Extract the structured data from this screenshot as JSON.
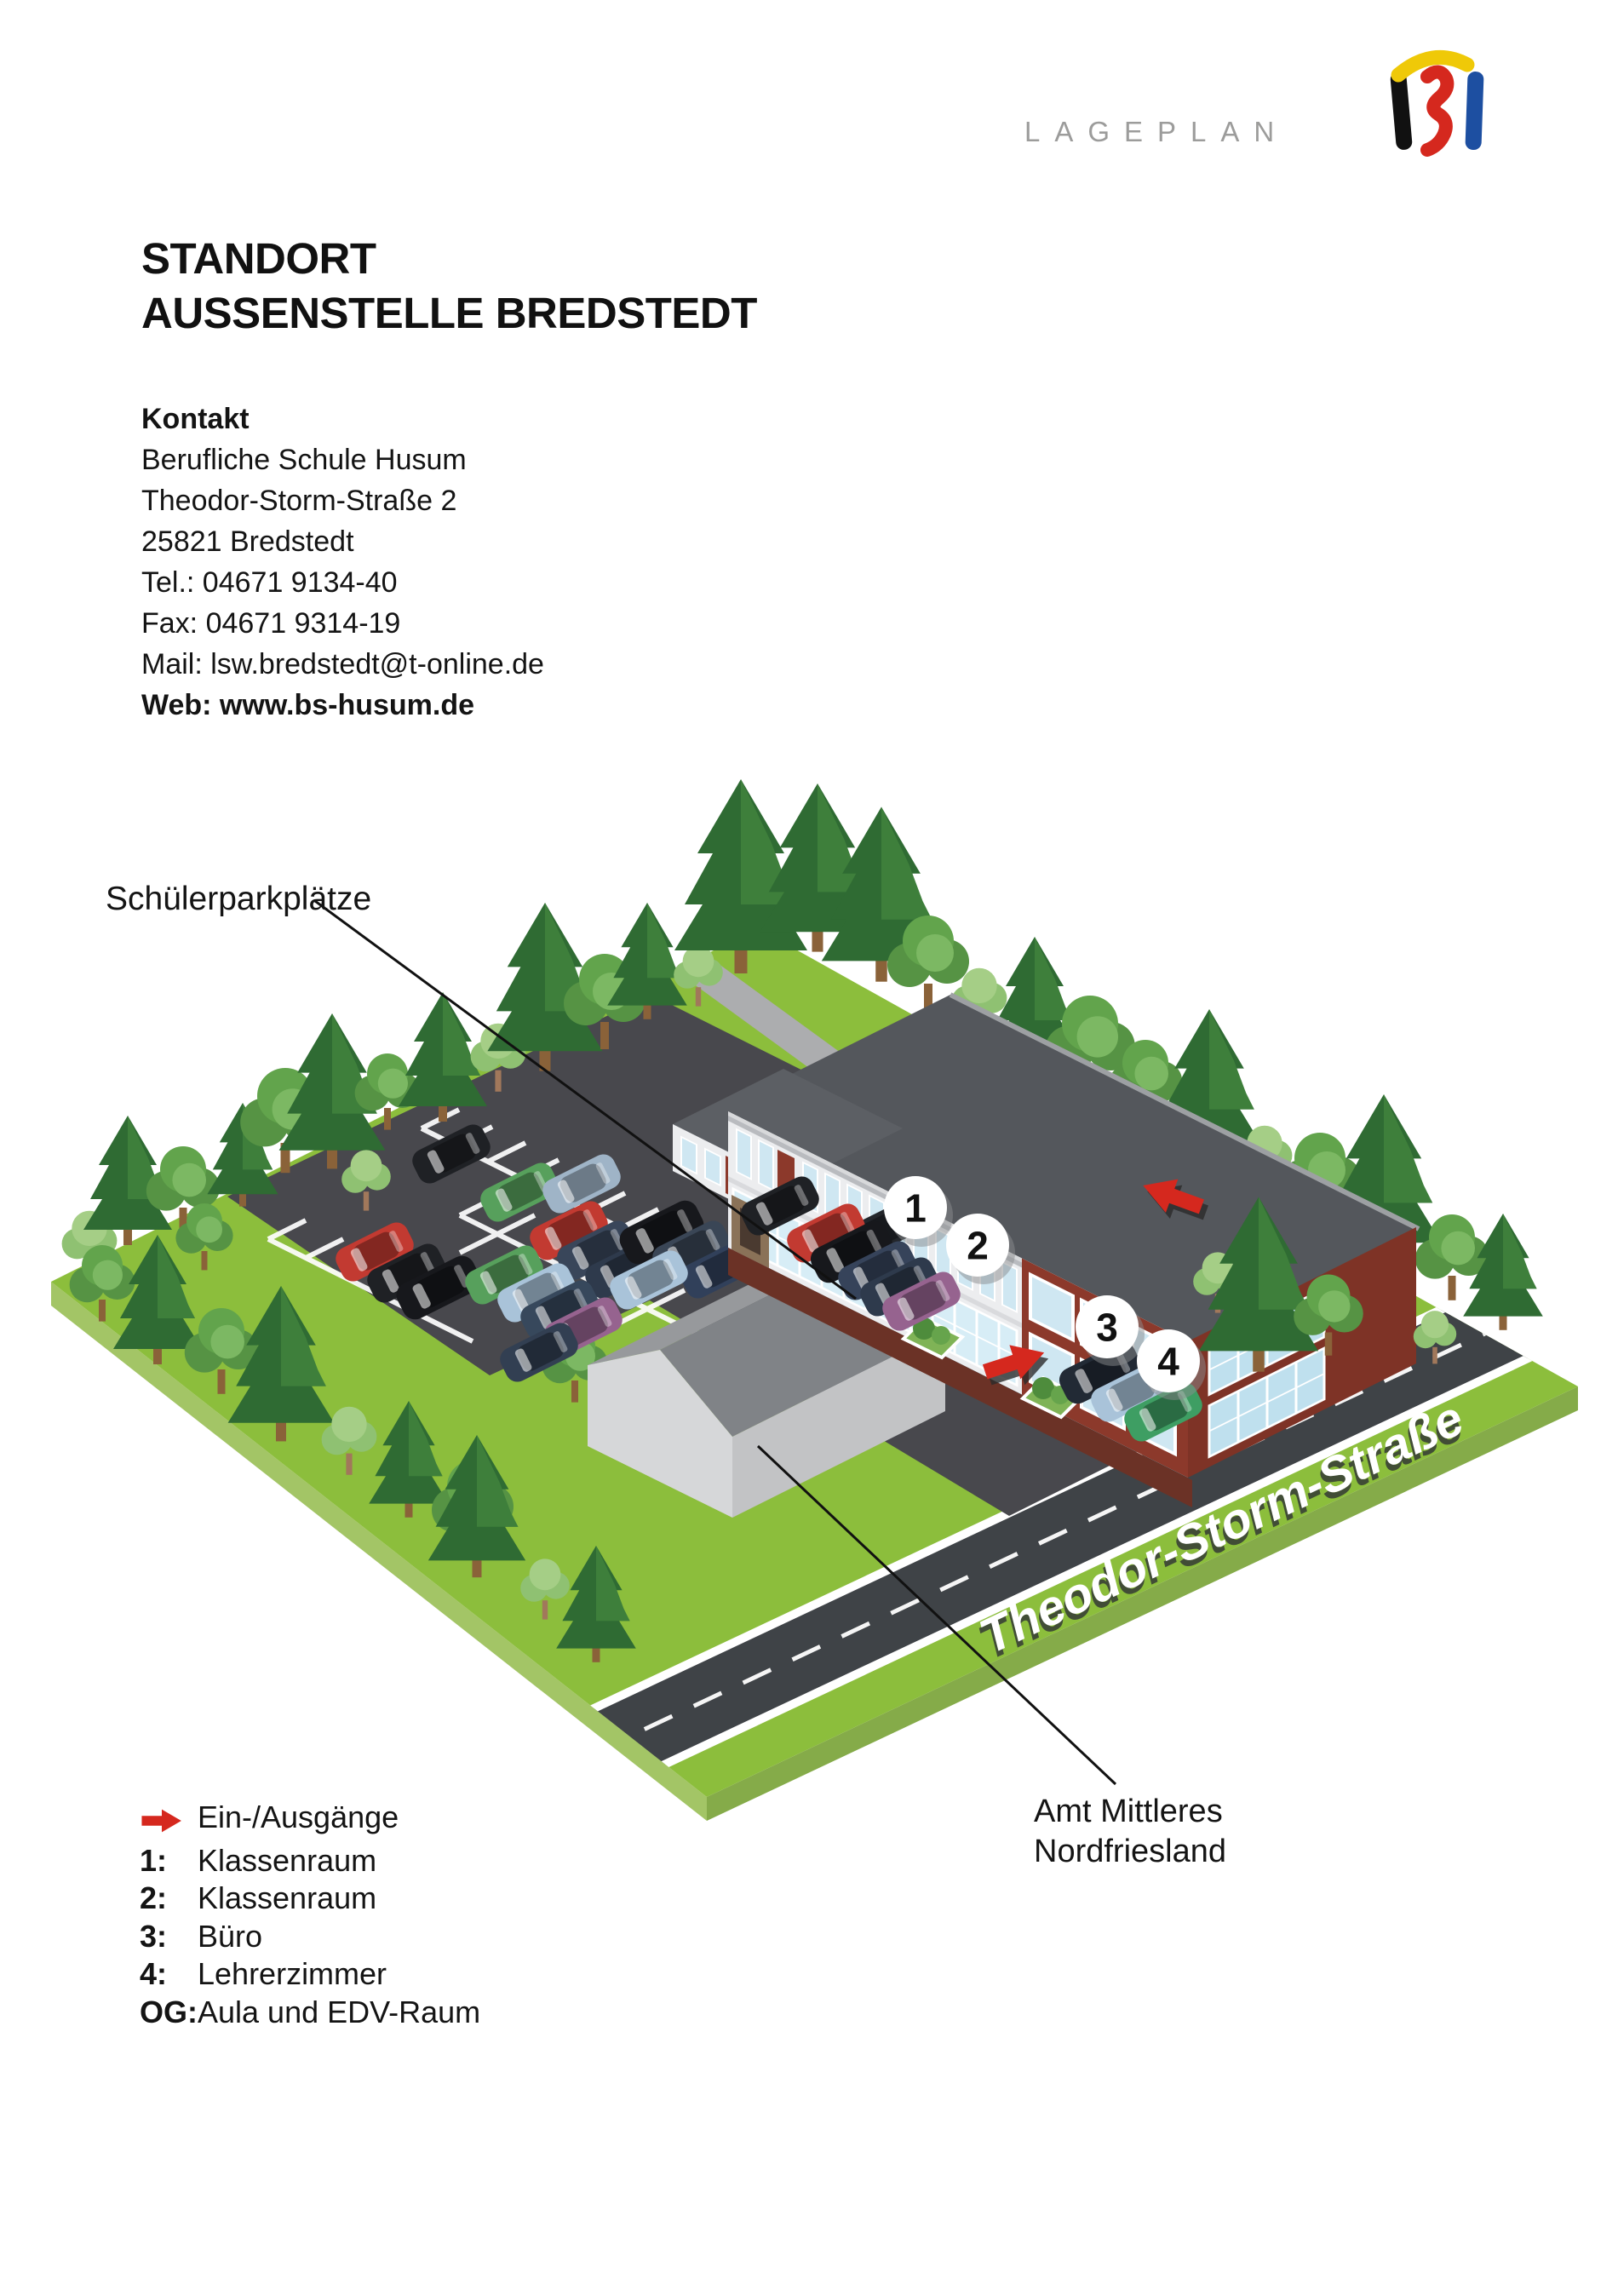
{
  "header": {
    "wordmark": "LAGEPLAN"
  },
  "title": {
    "line1": "STANDORT",
    "line2": "AUSSENSTELLE BREDSTEDT"
  },
  "contact": {
    "heading": "Kontakt",
    "lines": [
      "Berufliche Schule Husum",
      "Theodor-Storm-Straße 2",
      "25821 Bredstedt",
      "Tel.: 04671 9134-40",
      "Fax: 04671 9314-19",
      "Mail: lsw.bredstedt@t-online.de"
    ],
    "web": "Web: www.bs-husum.de"
  },
  "map": {
    "street_name": "Theodor-Storm-Straße",
    "parking_label": "Schülerparkplätze",
    "amt_label_line1": "Amt Mittleres",
    "amt_label_line2": "Nordfriesland",
    "markers": [
      {
        "number": "1"
      },
      {
        "number": "2"
      },
      {
        "number": "3"
      },
      {
        "number": "4"
      }
    ]
  },
  "legend": {
    "entrance_label": "Ein-/Ausgänge",
    "items": [
      {
        "key": "1:",
        "label": "Klassenraum"
      },
      {
        "key": "2:",
        "label": "Klassenraum"
      },
      {
        "key": "3:",
        "label": "Büro"
      },
      {
        "key": "4:",
        "label": "Lehrerzimmer"
      },
      {
        "key": "OG:",
        "label": "Aula und EDV-Raum"
      }
    ]
  },
  "palette": {
    "accent_red": "#D5281E",
    "ground_green": "#8CBE3C",
    "asphalt": "#48484D",
    "street": "#3F4347",
    "roof_gray": "#54575C",
    "brick_red": "#8C392B",
    "path_gray": "#ACADAF",
    "wordmark_gray": "#9C9C9B",
    "logo_black": "#111111",
    "logo_yellow": "#EFC908",
    "logo_red": "#D5281E",
    "logo_blue": "#1D4FA1"
  }
}
